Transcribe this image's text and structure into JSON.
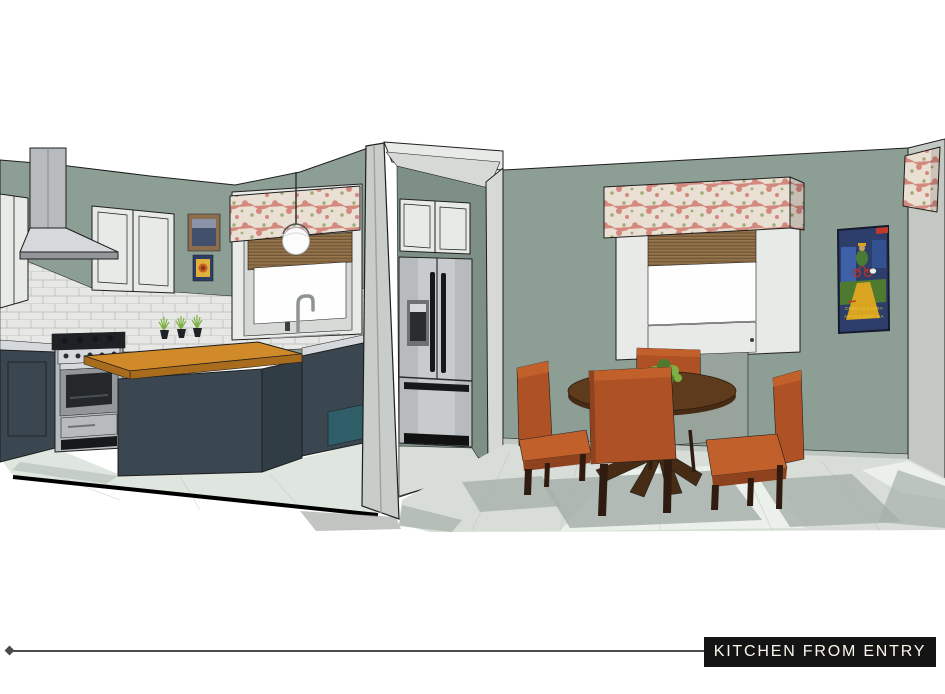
{
  "footer": {
    "label": "KITCHEN FROM ENTRY"
  },
  "scene": {
    "caption": "KITCHEN FROM ENTRY",
    "poster": {
      "line1": "CKEN IN EVERY",
      "line2": "AR IN EVERY GA"
    }
  },
  "palette": {
    "bg": "#ffffff",
    "wall_sage": "#8D9E95",
    "wall_sage_dark": "#7E9086",
    "wall_right": "#C3C8C3",
    "wall_edge": "#C9CDC9",
    "wall_edge_dark": "#9FA49F",
    "cab_white": "#E8EAE7",
    "cab_white_shade": "#D6D9D5",
    "tile": "#E7E8E5",
    "grout": "#C2C4C1",
    "navy": "#3A4750",
    "navy_dark": "#313D45",
    "teal": "#2F5D68",
    "steel": "#B7BBBD",
    "steel_dark": "#93979A",
    "steel_light": "#D6D9DB",
    "black_part": "#1E2226",
    "wood_top": "#D08A2A",
    "wood_dark": "#A96B1C",
    "floor_kitchen": "#DFE5DF",
    "floor_dining": "#D8DED7",
    "floor_bright": "#ECF0EA",
    "floor_shadow": "#A7B0AA",
    "valance_base": "#EADFD3",
    "valance_pink": "#D4897E",
    "valance_green": "#9FAB79",
    "bamboo": "#8A6A43",
    "bamboo_dark": "#6B5132",
    "rust": "#AE5125",
    "rust_light": "#C2602C",
    "rust_dark": "#8F421E",
    "leg_brown": "#2F1B10",
    "table_wood": "#5E3B1D",
    "table_wood_dark": "#462C14",
    "plant_green": "#4F7A2E",
    "plant_green_light": "#7FB043",
    "poster_navy": "#2E3E6B",
    "poster_blue": "#3D60A8",
    "poster_yellow": "#D9A520",
    "poster_green": "#4E7A2F",
    "poster_red": "#C03A2B",
    "poster_text": "#E8C13C",
    "frame_brown": "#8A6E4E",
    "frame_navy": "#2C3E66",
    "art_yellow": "#E0B23C",
    "label_bg": "#141414",
    "label_text": "#FBF7EC",
    "leader_line": "#4B4B4B"
  }
}
